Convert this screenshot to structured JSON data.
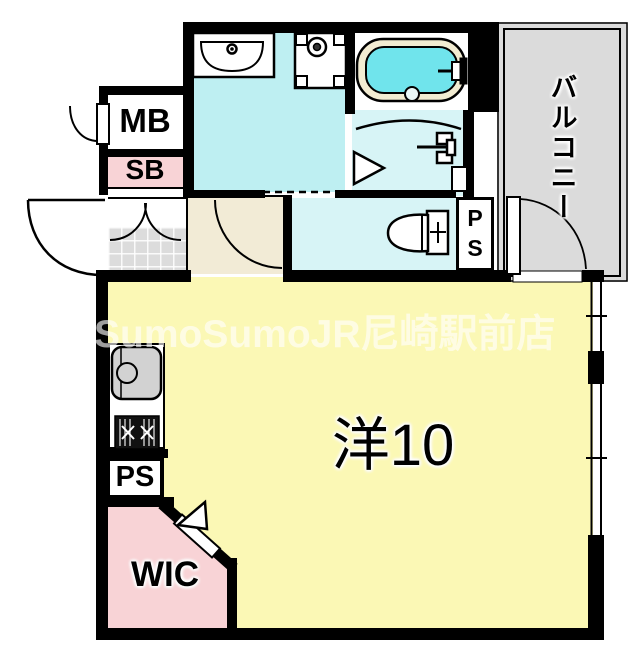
{
  "labels": {
    "mb": "MB",
    "sb": "SB",
    "ps_left": "PS",
    "ps_right": "PS",
    "wic": "WIC",
    "balcony": "バルコニー",
    "main_room": "洋10"
  },
  "watermark": "SumoSumoJR尼崎駅前店",
  "colors": {
    "wall": "#000000",
    "washroom": "#BEEFF2",
    "bath_floor": "#D7F4F6",
    "toilet_floor": "#D7F4F6",
    "water": "#70E4EC",
    "tub_rim": "#F2ECD2",
    "room": "#FBF8B5",
    "pink": "#F8D3D6",
    "balcony": "#DBDBDB",
    "tile": "#DCDCDC",
    "hall": "#F2EBD6",
    "sink": "#D2D2D2"
  }
}
